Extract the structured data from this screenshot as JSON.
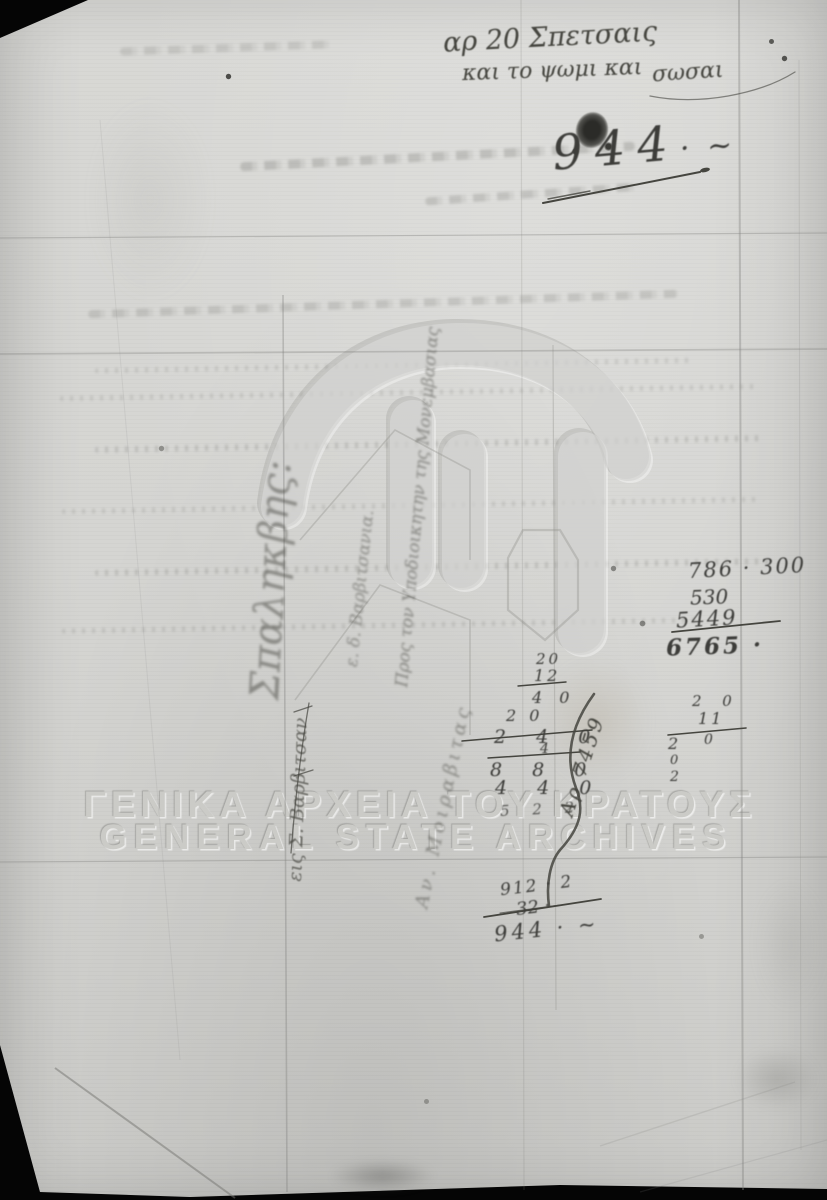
{
  "watermark": {
    "line1": "ΓΕΝΙΚΑ ΑΡΧΕΙΑ ΤΟΥ ΚΡΑΤΟΥΣ",
    "line2": "GENERAL STATE ARCHIVES"
  },
  "header_note": {
    "line1": "αρ 20 Σπετσαις",
    "line2": "και το ψωμι και",
    "line2_cont": "σωσαι"
  },
  "doc_number": {
    "value": "944",
    "flourish": "· ~"
  },
  "addition_block": {
    "row1": "786 · 300",
    "row2": "530",
    "row3": "5449",
    "total": "6765 ·"
  },
  "calc_block": {
    "r1": "20",
    "r2": "12",
    "r3": "4 0",
    "r4": "2 0",
    "r5": "2 4 0",
    "r5b": "4",
    "r6": "8 8 0",
    "r7": "4 4 0",
    "r8": "5 2 2"
  },
  "calc_annotation": "Αρ 7459",
  "small_block": {
    "r1": "2 0",
    "r2": "11",
    "r3": "2",
    "r3b": "0",
    "r4": "0",
    "r5": "2"
  },
  "sum_block": {
    "r1": "912 · 2",
    "r2": "32 ·",
    "total": "944 · ~"
  },
  "side_notes": {
    "tall_cursive": "Σπαληκβης:",
    "address_line1": "Προς τον Υποδιοικητην της Μονεμβασιας",
    "address_line2": "ε. δ. Βαρβιτσανια.",
    "place_note": "εις Σ. Βαρβιτσαν",
    "diagonal_note": "Αν. Μοιραβιτας"
  },
  "colors": {
    "paper": "#d5d5d2",
    "ink": "#3d3d3a",
    "watermark": "#cbcbc7",
    "background": "#050505"
  }
}
